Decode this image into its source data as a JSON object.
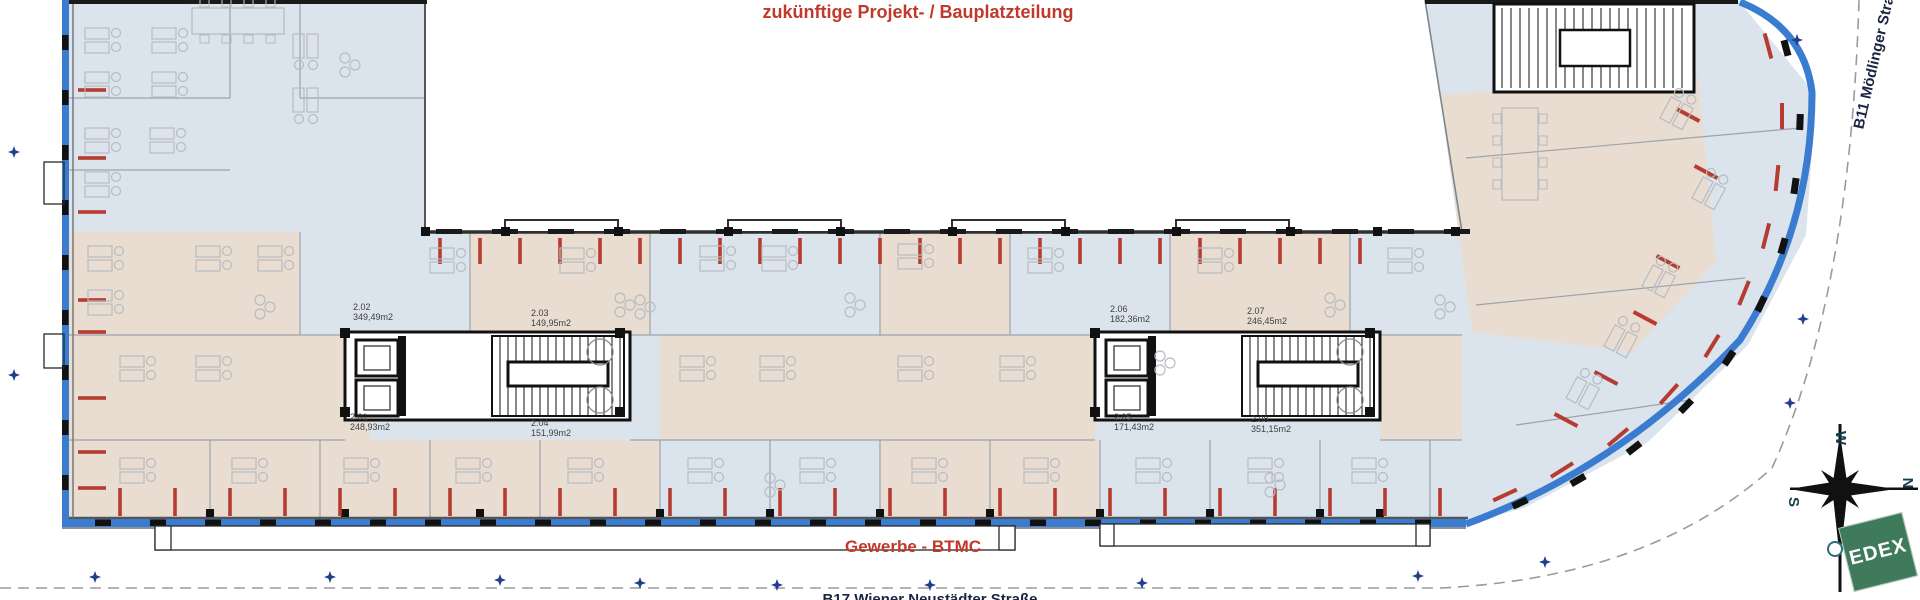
{
  "annotations": {
    "future_project": "zukünftige Projekt- / Bauplatzteilung",
    "commercial": "Gewerbe - BTMC"
  },
  "streets": {
    "right": "B11 Mödlinger Straße",
    "bottom": "B17 Wiener Neustädter Straße"
  },
  "rooms": [
    {
      "id": "2.01",
      "area": "248,93m2"
    },
    {
      "id": "2.02",
      "area": "349,49m2"
    },
    {
      "id": "2.03",
      "area": "149,95m2"
    },
    {
      "id": "2.04",
      "area": "151,99m2"
    },
    {
      "id": "2.05",
      "area": "171,43m2"
    },
    {
      "id": "2.06",
      "area": "182,36m2"
    },
    {
      "id": "2.07",
      "area": "246,45m2"
    },
    {
      "id": "2.08",
      "area": "351,15m2"
    }
  ],
  "compass": {
    "n": "N",
    "e": "E",
    "s": "S",
    "w": "W"
  },
  "logo": {
    "text": "EDEX",
    "color": "#3f7a5a"
  },
  "colors": {
    "annotation_red": "#c0392b",
    "street_text": "#1b2440",
    "room_blue": "#dbe4ec",
    "room_beige": "#e9ddd1",
    "facade_blue": "#3a7cd0",
    "radiator_red": "#b63b30",
    "wall_dark": "#2f2f2f",
    "wall_gray": "#9aa3ab",
    "furniture_gray": "#b7bcc2",
    "boundary_gray": "#9b9b9b",
    "marker_blue": "#1f3d8c"
  }
}
